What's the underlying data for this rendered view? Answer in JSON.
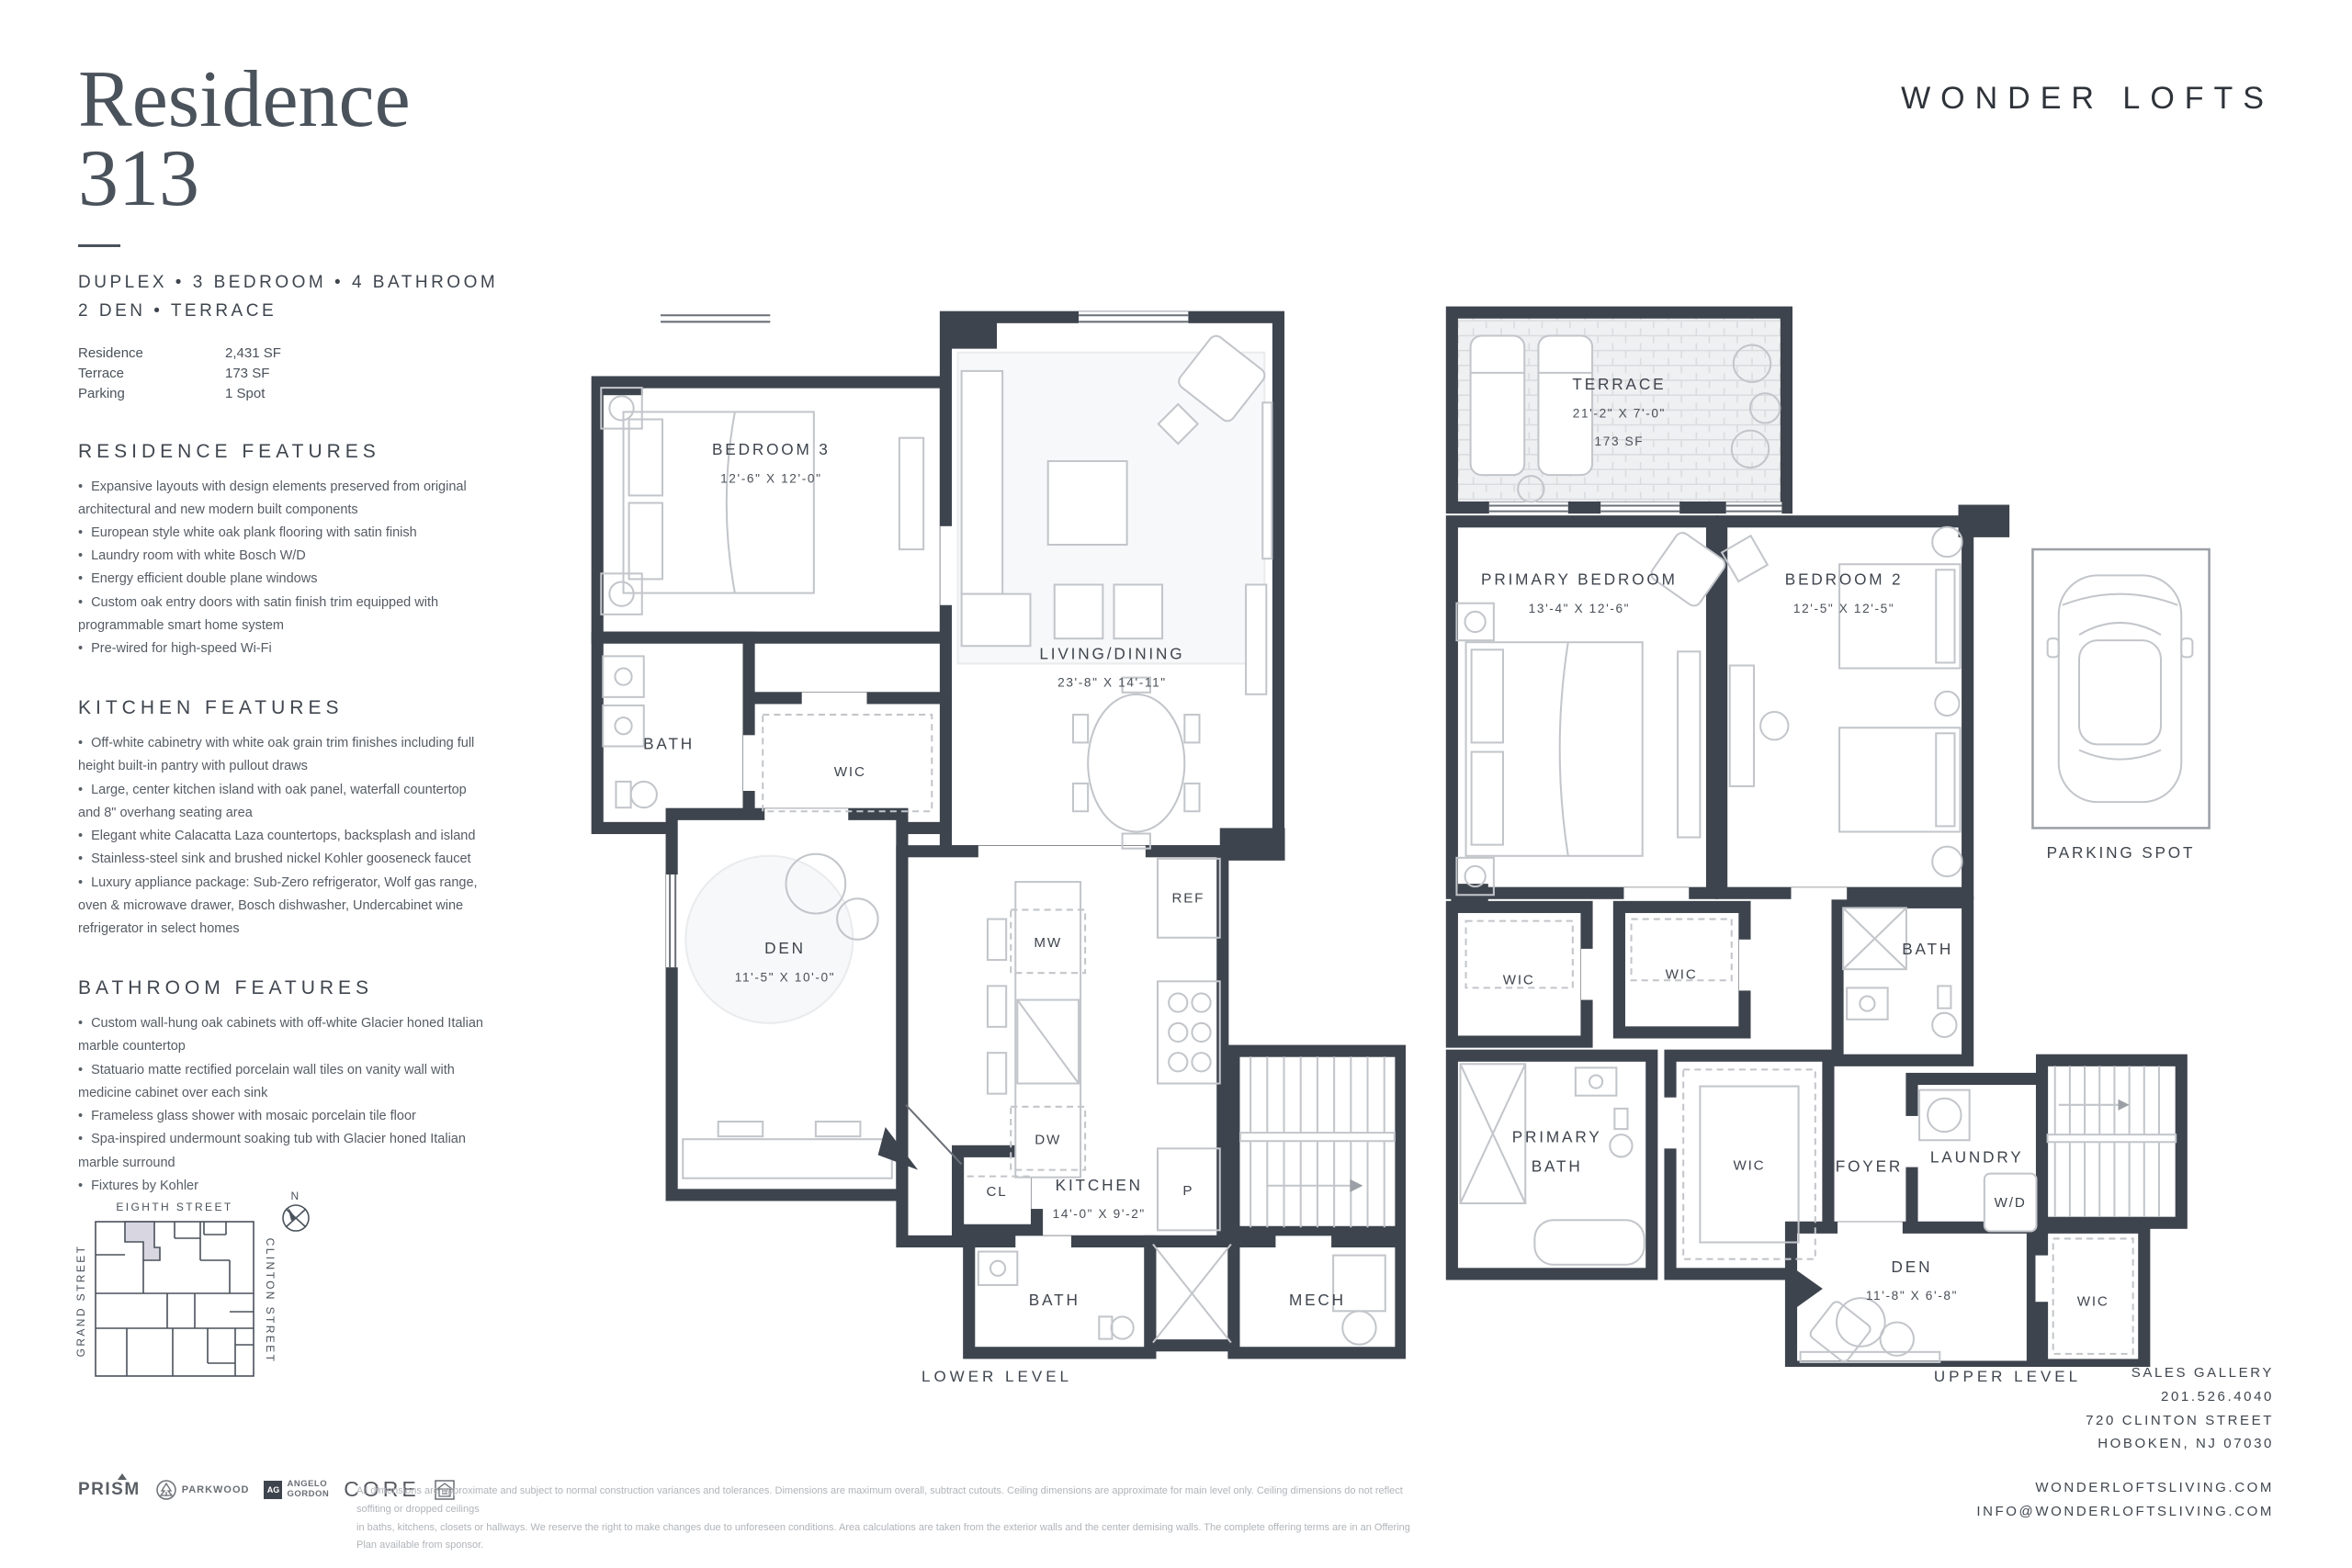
{
  "brand": {
    "logo": "WONDER LOFTS"
  },
  "header": {
    "title_line1": "Residence",
    "title_line2": "313",
    "subtitle_line1": "DUPLEX • 3 BEDROOM • 4 BATHROOM",
    "subtitle_line2": "2 DEN • TERRACE"
  },
  "specs": [
    {
      "label": "Residence",
      "value": "2,431 SF"
    },
    {
      "label": "Terrace",
      "value": "173 SF"
    },
    {
      "label": "Parking",
      "value": "1 Spot"
    }
  ],
  "sections": [
    {
      "heading": "RESIDENCE FEATURES",
      "items": [
        "Expansive layouts with design elements preserved from original architectural and new modern built components",
        "European style white oak plank flooring with satin finish",
        "Laundry room with white Bosch W/D",
        "Energy efficient double plane windows",
        "Custom oak entry doors with satin finish trim equipped with programmable smart home system",
        "Pre-wired for high-speed Wi-Fi"
      ]
    },
    {
      "heading": "KITCHEN FEATURES",
      "items": [
        "Off-white cabinetry with white oak grain trim finishes including full height built-in pantry with pullout draws",
        "Large, center kitchen island with oak panel, waterfall countertop and 8\" overhang seating area",
        "Elegant white Calacatta Laza countertops, backsplash and island",
        "Stainless-steel sink and brushed nickel Kohler gooseneck faucet",
        "Luxury appliance package: Sub-Zero refrigerator, Wolf gas range, oven & microwave drawer, Bosch dishwasher, Undercabinet wine refrigerator in select homes"
      ]
    },
    {
      "heading": "BATHROOM FEATURES",
      "items": [
        "Custom wall-hung oak cabinets with off-white Glacier honed Italian marble countertop",
        "Statuario matte rectified porcelain wall tiles on vanity wall with medicine cabinet over each sink",
        "Frameless glass shower with mosaic porcelain tile floor",
        "Spa-inspired undermount soaking tub with Glacier honed Italian marble surround",
        "Fixtures by Kohler"
      ]
    }
  ],
  "site_map": {
    "street_top": "EIGHTH STREET",
    "street_left": "GRAND STREET",
    "street_right": "CLINTON STREET",
    "compass": "N"
  },
  "lower_plan": {
    "level": "LOWER LEVEL",
    "labels": {
      "bedroom3": "BEDROOM 3",
      "bedroom3_dim": "12'-6\" X 12'-0\"",
      "living": "LIVING/DINING",
      "living_dim": "23'-8\" X 14'-11\"",
      "bath": "BATH",
      "wic": "WIC",
      "den": "DEN",
      "den_dim": "11'-5\" X 10'-0\"",
      "kitchen": "KITCHEN",
      "kitchen_dim": "14'-0\" X 9'-2\"",
      "ref": "REF",
      "mw": "MW",
      "dw": "DW",
      "p": "P",
      "cl": "CL",
      "mech": "MECH"
    }
  },
  "upper_plan": {
    "level": "UPPER LEVEL",
    "labels": {
      "terrace": "TERRACE",
      "terrace_dim": "21'-2\" X 7'-0\"",
      "terrace_sf": "173 SF",
      "primary_bedroom": "PRIMARY BEDROOM",
      "primary_dim": "13'-4\" X 12'-6\"",
      "bedroom2": "BEDROOM 2",
      "bedroom2_dim": "12'-5\" X 12'-5\"",
      "wic": "WIC",
      "bath": "BATH",
      "primary_bath_1": "PRIMARY",
      "primary_bath_2": "BATH",
      "foyer": "FOYER",
      "laundry": "LAUNDRY",
      "wd": "W/D",
      "den": "DEN",
      "den_dim": "11'-8\" X 6'-8\"",
      "parking": "PARKING SPOT"
    }
  },
  "footer": {
    "logos": {
      "prism": "PRISM",
      "parkwood": "PARKWOOD",
      "angelo_line1": "ANGELO",
      "angelo_line2": "GORDON",
      "core": "CORE"
    },
    "disclaimer_line1": "All dimensions are approximate and subject to normal construction variances and tolerances. Dimensions are maximum overall, subtract cutouts. Ceiling dimensions are approximate for main level only. Ceiling dimensions do not reflect soffiting or dropped ceilings",
    "disclaimer_line2": "in baths, kitchens, closets or hallways. We reserve the right to make changes due to unforeseen conditions. Area calculations are taken from the exterior walls and the center demising walls. The complete offering terms are in an Offering Plan available from sponsor.",
    "contact_line1": "SALES GALLERY",
    "contact_line2": "201.526.4040",
    "contact_line3": "720 CLINTON STREET",
    "contact_line4": "HOBOKEN, NJ 07030",
    "web": "WONDERLOFTSLIVING.COM",
    "email": "INFO@WONDERLOFTSLIVING.COM"
  }
}
